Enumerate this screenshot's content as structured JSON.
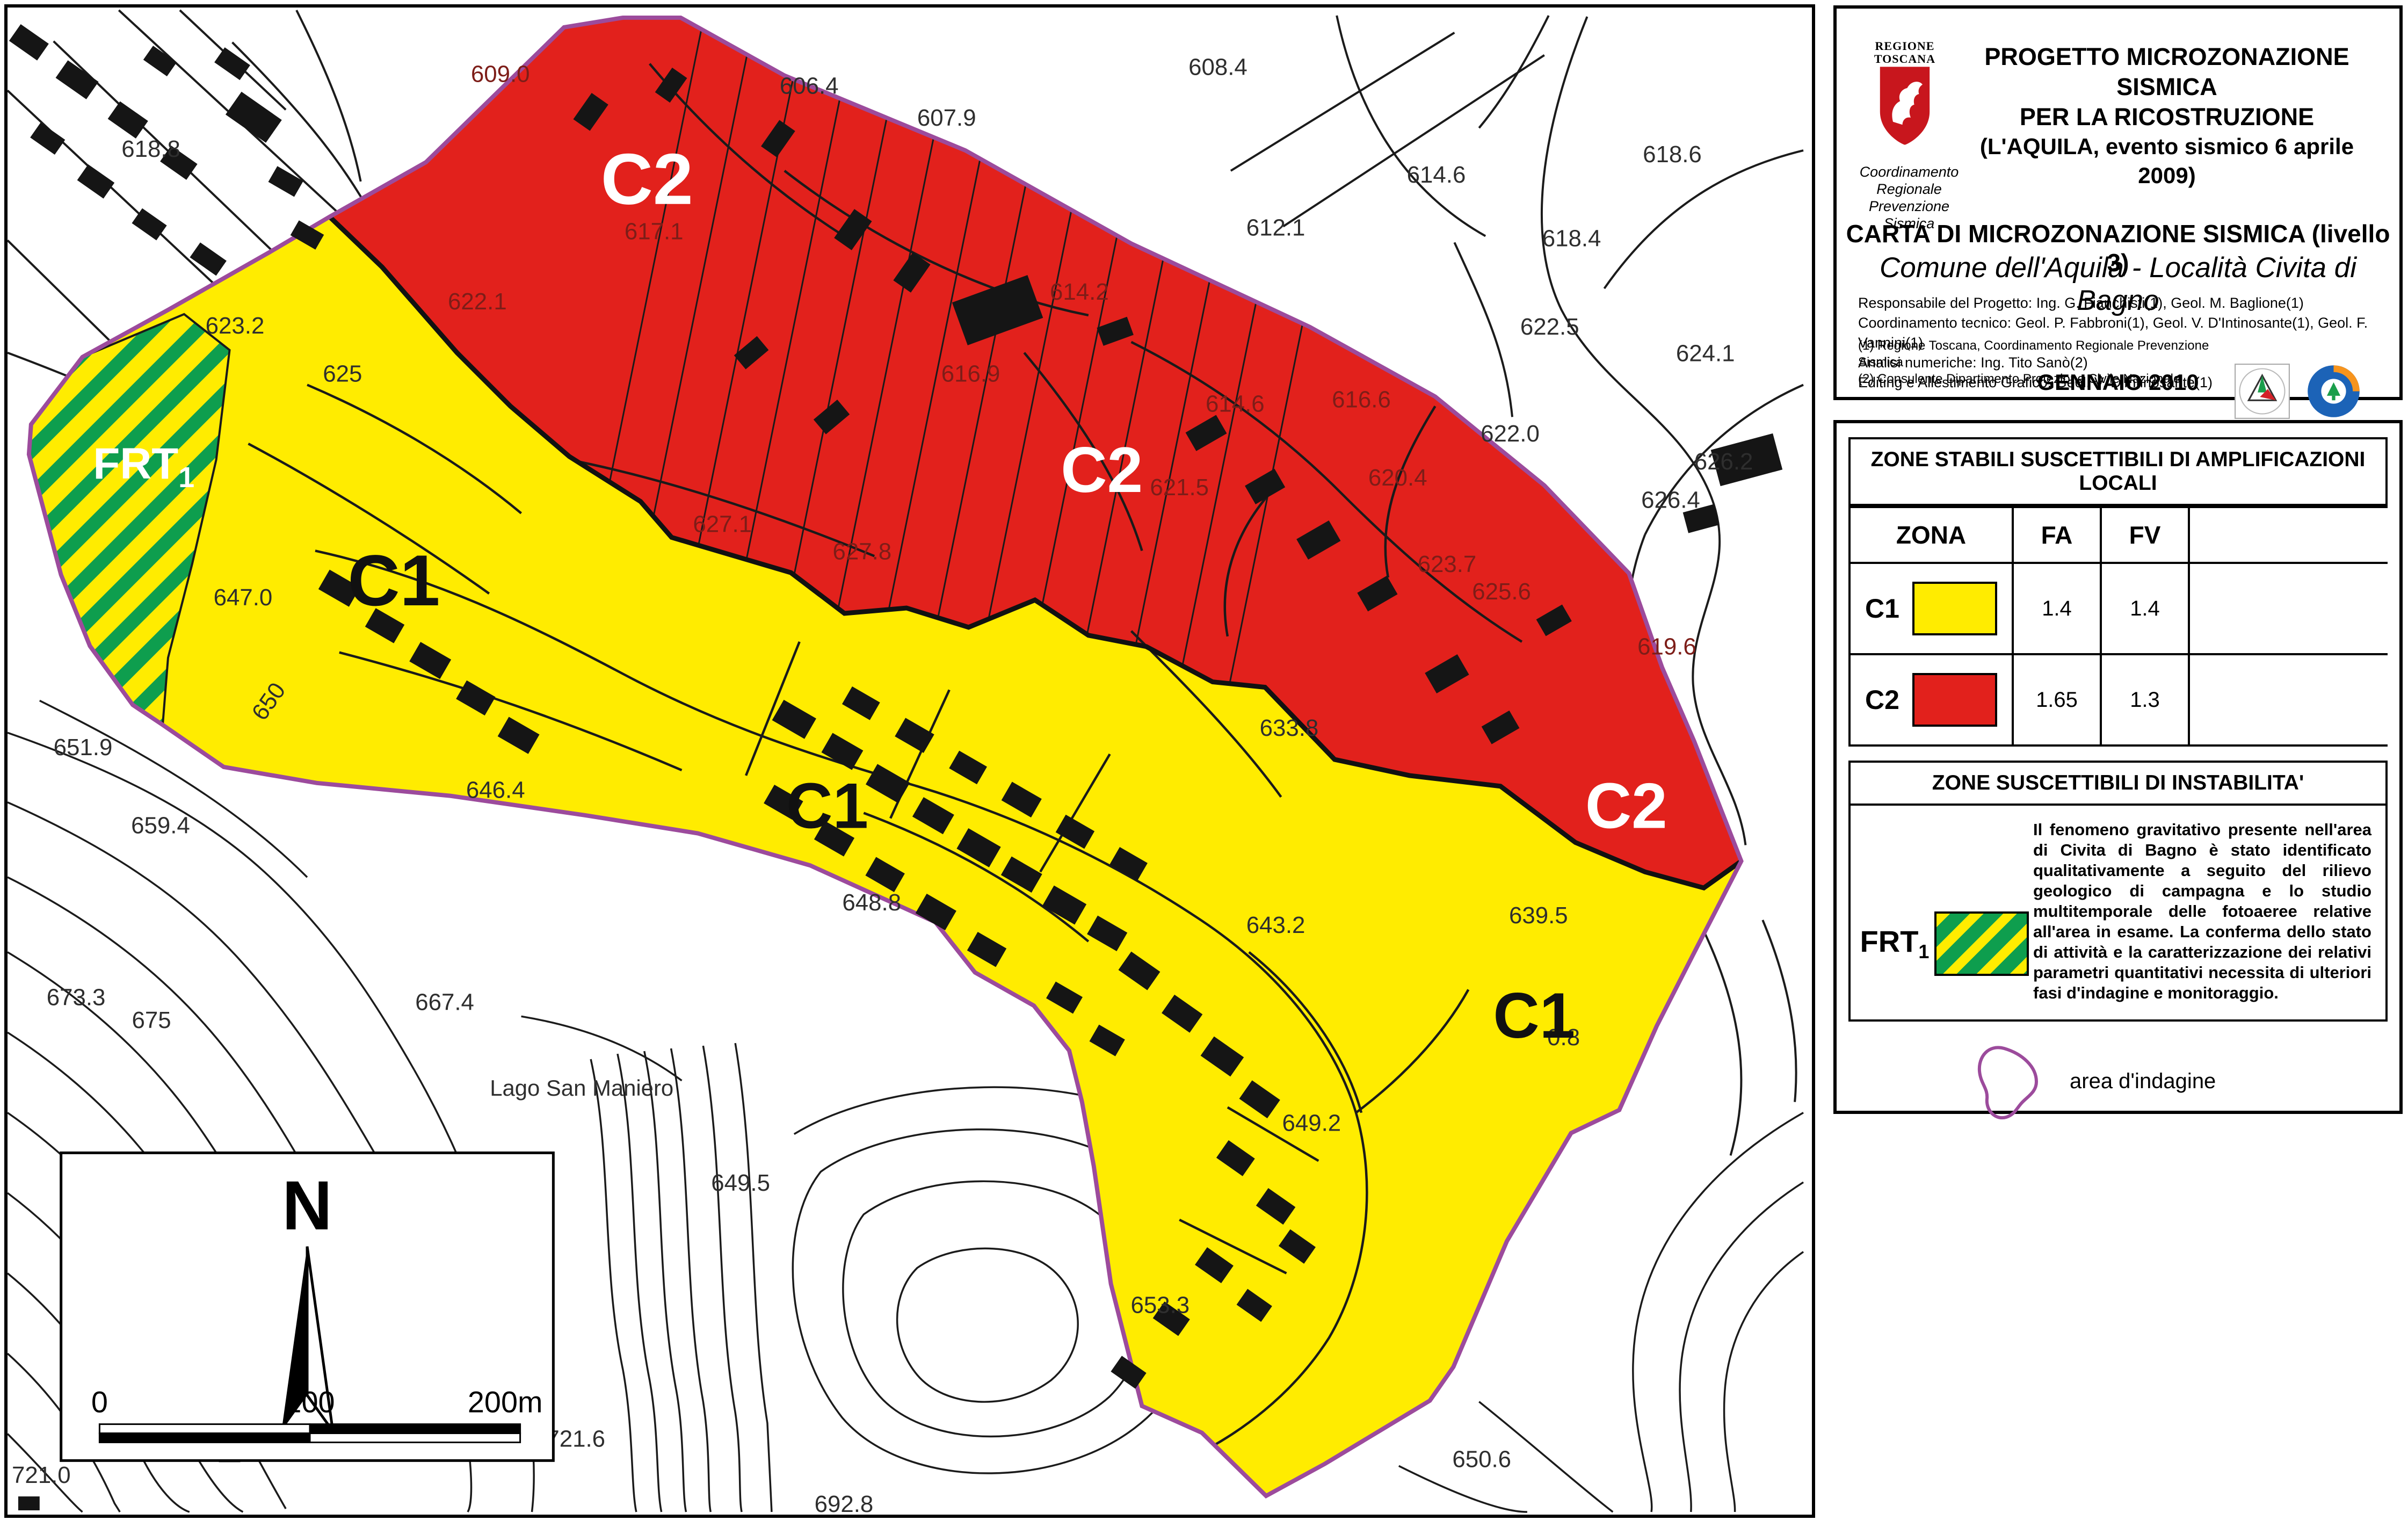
{
  "colors": {
    "zone_c1_yellow": "#ffec00",
    "zone_c2_red": "#e2211c",
    "frt_green_hatch": "#0e9e4e",
    "boundary_purple": "#9c4b9c",
    "red_zone_label_maroon": "#7d1d18",
    "map_label_gray": "#2e2e2e"
  },
  "title_block": {
    "logo_region_line1": "REGIONE",
    "logo_region_line2": "TOSCANA",
    "project_title_line1": "PROGETTO MICROZONAZIONE SISMICA",
    "project_title_line2": "PER LA RICOSTRUZIONE",
    "project_title_line3": "(L'AQUILA, evento sismico 6 aprile 2009)",
    "coordination_line1": "Coordinamento Regionale",
    "coordination_line2": "Prevenzione Sismica",
    "map_title": "CARTA DI MICROZONAZIONE SISMICA (livello 3)",
    "map_subtitle": "Comune dell'Aquila - Località Civita di Bagno",
    "credit_line1": "Responsabile del Progetto: Ing. G. Fianchisti(1), Geol. M. Baglione(1)",
    "credit_line2": "Coordinamento tecnico: Geol. P. Fabbroni(1), Geol. V. D'Intinosante(1), Geol. F. Vannini(1)",
    "credit_line3": "Analisi numeriche: Ing. Tito Sanò(2)",
    "credit_line4": "Editing e Allestimento Grafico:  Geol. V. D'Intinosante(1)",
    "footnote_line1": "(1) Regione Toscana, Coordinamento Regionale Prevenzione Sismica",
    "footnote_line2": "(2) Consulente Dipartimento Protezione Civile Nazionale",
    "date": "GENNAIO 2010"
  },
  "amplification_legend": {
    "header": "ZONE STABILI SUSCETTIBILI DI AMPLIFICAZIONI LOCALI",
    "col_zona": "ZONA",
    "col_fa": "FA",
    "col_fv": "FV",
    "rows": [
      {
        "zone": "C1",
        "fa": "1.4",
        "fv": "1.4"
      },
      {
        "zone": "C2",
        "fa": "1.65",
        "fv": "1.3"
      }
    ]
  },
  "instability_legend": {
    "header": "ZONE SUSCETTIBILI DI INSTABILITA'",
    "code": "FRT",
    "code_sub": "1",
    "description": "Il fenomeno gravitativo presente nell'area di Civita di Bagno è stato identificato qualitativamente a seguito del rilievo geologico di campagna e lo studio multitemporale delle fotoaeree relative all'area in esame. La conferma dello stato di attività e la caratterizzazione dei relativi parametri quantitativi necessita di ulteriori fasi d'indagine e monitoraggio."
  },
  "area_of_investigation": {
    "label": "area d'indagine"
  },
  "map": {
    "north_label": "N",
    "scale_bar": {
      "tick0": "0",
      "tick100": "100",
      "tick200": "200m"
    },
    "place_label": "Lago San Maniero",
    "frt_label": {
      "text": "FRT",
      "sub": "1"
    },
    "zone_big_labels": [
      {
        "text": "C2"
      },
      {
        "text": "C2"
      },
      {
        "text": "C2"
      },
      {
        "text": "C1"
      },
      {
        "text": "C1"
      },
      {
        "text": "C1"
      }
    ],
    "elevation_labels": [
      {
        "text": "618.8"
      },
      {
        "text": "609.0"
      },
      {
        "text": "606.4"
      },
      {
        "text": "607.9"
      },
      {
        "text": "608.4"
      },
      {
        "text": "612.1"
      },
      {
        "text": "614.6"
      },
      {
        "text": "618.6"
      },
      {
        "text": "618.4"
      },
      {
        "text": "622.5"
      },
      {
        "text": "624.1"
      },
      {
        "text": "626.2"
      },
      {
        "text": "626.4"
      },
      {
        "text": "622.0"
      },
      {
        "text": "617.1"
      },
      {
        "text": "622.1"
      },
      {
        "text": "614.2"
      },
      {
        "text": "616.9"
      },
      {
        "text": "621.5"
      },
      {
        "text": "627.1"
      },
      {
        "text": "627.8"
      },
      {
        "text": "620.4"
      },
      {
        "text": "616.6"
      },
      {
        "text": "623.7"
      },
      {
        "text": "625.6"
      },
      {
        "text": "614.6"
      },
      {
        "text": "619.6"
      },
      {
        "text": "623.2"
      },
      {
        "text": "625"
      },
      {
        "text": "647.0"
      },
      {
        "text": "646.4"
      },
      {
        "text": "633.8"
      },
      {
        "text": "643.2"
      },
      {
        "text": "639.5"
      },
      {
        "text": "649.2"
      },
      {
        "text": "0.8"
      },
      {
        "text": "651.9"
      },
      {
        "text": "659.4"
      },
      {
        "text": "673.3"
      },
      {
        "text": "675"
      },
      {
        "text": "667.4"
      },
      {
        "text": "649.5"
      },
      {
        "text": "692.8"
      },
      {
        "text": "721.6"
      },
      {
        "text": "721.0"
      },
      {
        "text": "650.6"
      },
      {
        "text": "653.3"
      },
      {
        "text": "648.8"
      },
      {
        "text": "650"
      }
    ]
  }
}
